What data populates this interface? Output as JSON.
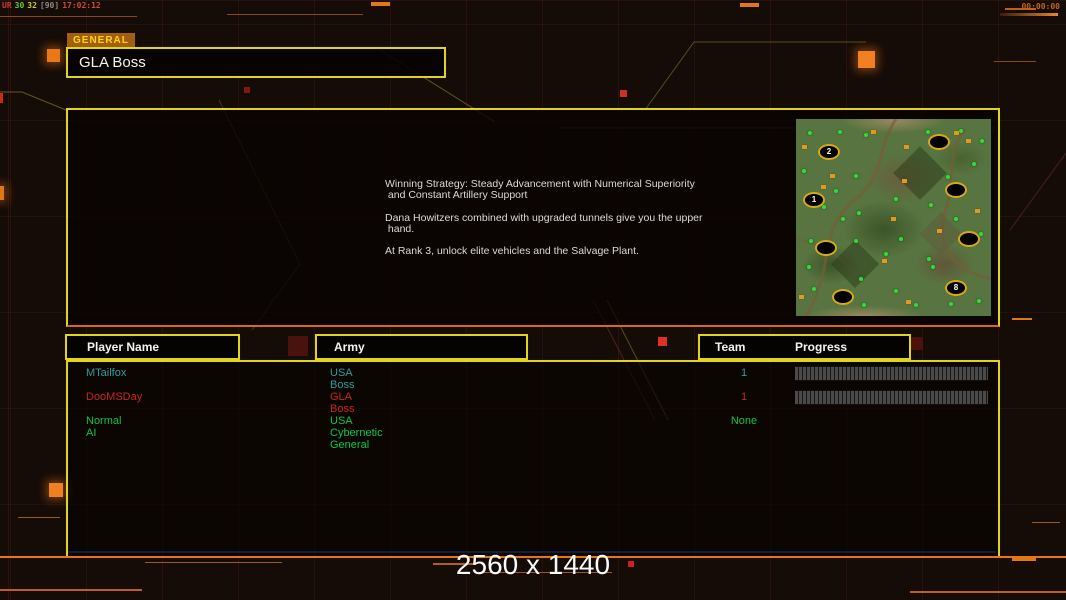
{
  "overlay": {
    "stats": [
      {
        "text": "UR",
        "color": "#cc3a30"
      },
      {
        "text": "30",
        "color": "#62c838"
      },
      {
        "text": "32",
        "color": "#c8c832"
      },
      {
        "text": "[90]",
        "color": "#8a8a8a"
      },
      {
        "text": "17:02:12",
        "color": "#cc4a30"
      }
    ],
    "timer": "00:00:00"
  },
  "general_tab": {
    "label": "GENERAL"
  },
  "title": {
    "value": "GLA Boss"
  },
  "briefing": {
    "lines": [
      "Winning Strategy: Steady Advancement with Numerical Superiority",
      " and Constant Artillery Support",
      "",
      "Dana Howitzers combined with upgraded tunnels give you the upper",
      " hand.",
      "",
      "At Rank 3, unlock elite vehicles and the Salvage Plant."
    ]
  },
  "minimap": {
    "start_positions": [
      {
        "label": "2",
        "x": 33,
        "y": 33
      },
      {
        "label": "",
        "x": 143,
        "y": 23
      },
      {
        "label": "1",
        "x": 18,
        "y": 81
      },
      {
        "label": "",
        "x": 160,
        "y": 71
      },
      {
        "label": "",
        "x": 173,
        "y": 120
      },
      {
        "label": "",
        "x": 30,
        "y": 129
      },
      {
        "label": "8",
        "x": 160,
        "y": 169
      },
      {
        "label": "",
        "x": 47,
        "y": 178
      }
    ],
    "trees": [
      [
        14,
        14
      ],
      [
        44,
        13
      ],
      [
        70,
        16
      ],
      [
        132,
        13
      ],
      [
        165,
        12
      ],
      [
        186,
        22
      ],
      [
        8,
        52
      ],
      [
        60,
        57
      ],
      [
        40,
        72
      ],
      [
        28,
        88
      ],
      [
        63,
        94
      ],
      [
        100,
        80
      ],
      [
        135,
        86
      ],
      [
        105,
        120
      ],
      [
        60,
        122
      ],
      [
        15,
        122
      ],
      [
        185,
        115
      ],
      [
        160,
        100
      ],
      [
        133,
        140
      ],
      [
        90,
        135
      ],
      [
        13,
        148
      ],
      [
        18,
        170
      ],
      [
        65,
        160
      ],
      [
        137,
        148
      ],
      [
        100,
        172
      ],
      [
        68,
        186
      ],
      [
        120,
        186
      ],
      [
        155,
        185
      ],
      [
        183,
        182
      ],
      [
        47,
        100
      ],
      [
        152,
        58
      ],
      [
        178,
        45
      ]
    ],
    "supplies": [
      [
        77,
        13
      ],
      [
        110,
        28
      ],
      [
        172,
        22
      ],
      [
        8,
        28
      ],
      [
        108,
        62
      ],
      [
        97,
        100
      ],
      [
        27,
        68
      ],
      [
        143,
        112
      ],
      [
        88,
        142
      ],
      [
        181,
        92
      ],
      [
        112,
        183
      ],
      [
        160,
        14
      ],
      [
        5,
        178
      ],
      [
        36,
        57
      ]
    ]
  },
  "table": {
    "headers": {
      "player": "Player Name",
      "army": "Army",
      "team": "Team",
      "progress": "Progress"
    },
    "rows": [
      {
        "player": "MTailfox",
        "army": "USA Boss",
        "team": "1",
        "color": "#2e9c9c",
        "progress_bar": true
      },
      {
        "player": "DooMSDay",
        "army": "GLA Boss",
        "team": "1",
        "color": "#c8271c",
        "progress_bar": true
      },
      {
        "player": "Normal AI",
        "army": "USA Cybernetic General",
        "team": "None",
        "color": "#12c24a",
        "progress_bar": false
      }
    ]
  },
  "footer": {
    "resolution": "2560 x 1440"
  },
  "colors": {
    "frame_yellow": "#e0d51a",
    "frame_orange": "#e8760e",
    "background": "#150c08",
    "tab_background": "#a2600e",
    "tab_text": "#ffd01e",
    "progress_segment": "#4a4a4a",
    "start_marker_gold": "#d8a818"
  }
}
